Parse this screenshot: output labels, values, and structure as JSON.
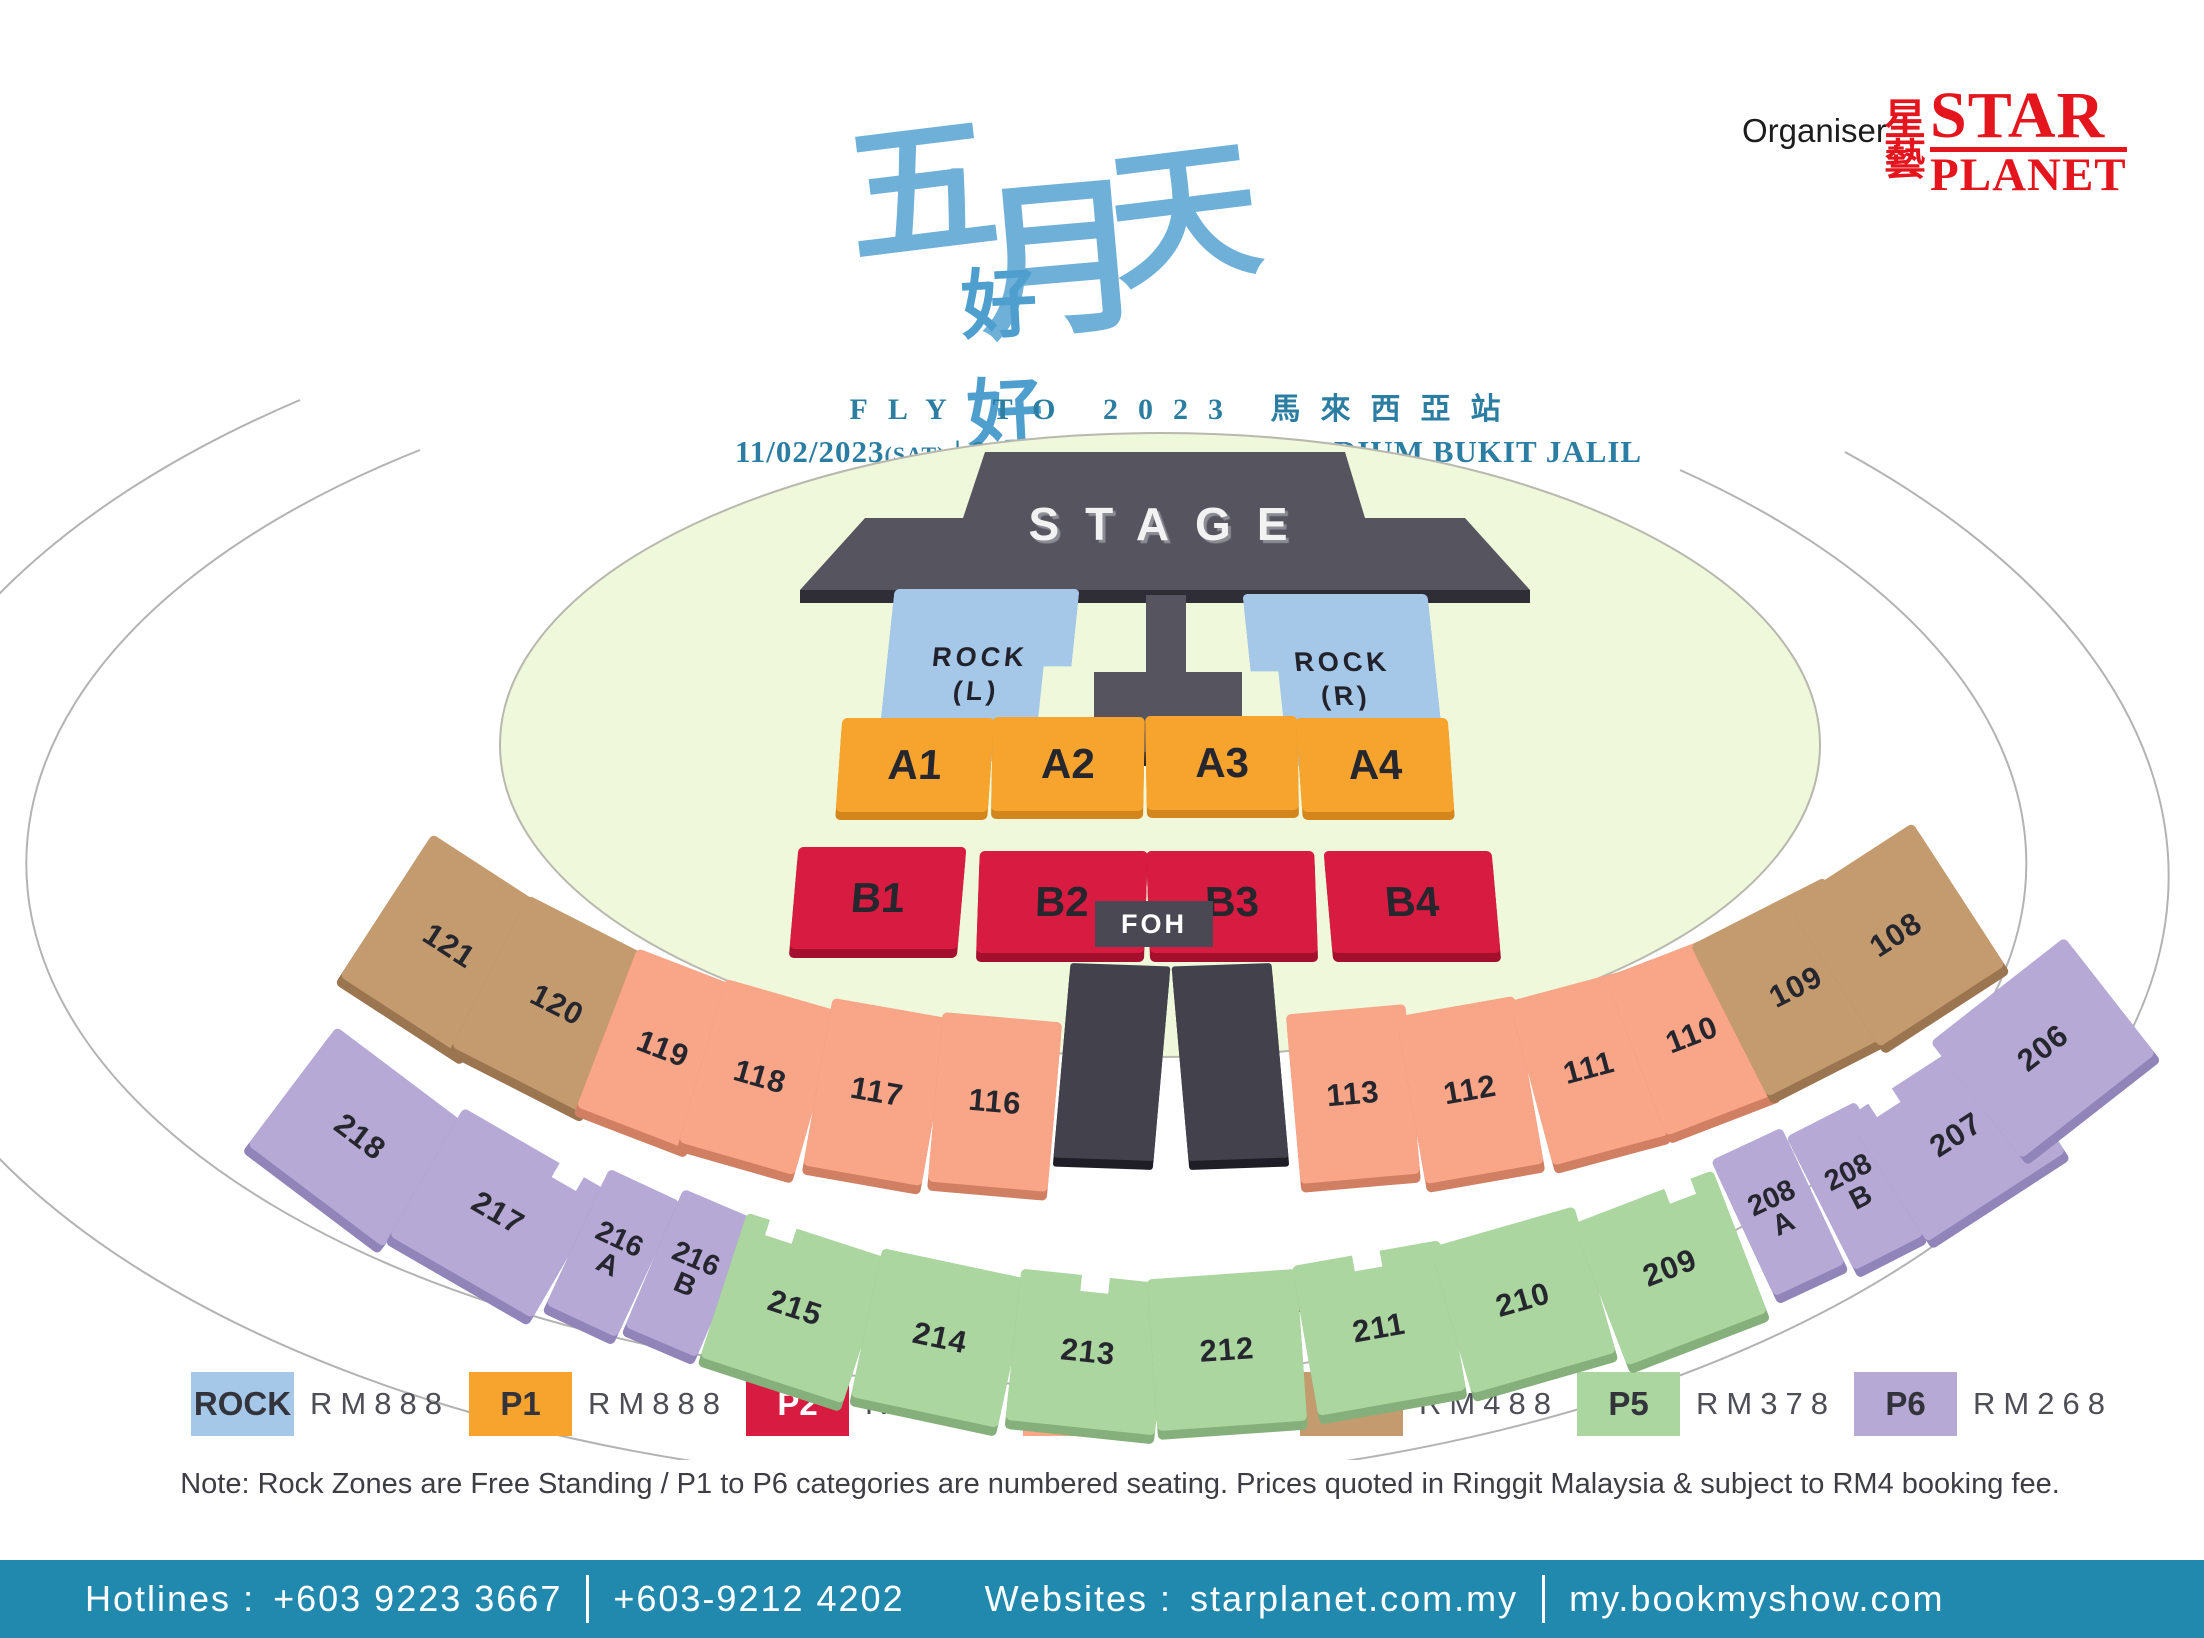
{
  "header": {
    "organiser_label": "Organiser",
    "logo": {
      "cjk_top": "星",
      "cjk_bottom": "藝",
      "star": "STAR",
      "planet": "PLANET",
      "color": "#e4151d"
    },
    "title": {
      "char1": "五",
      "char2": "月",
      "char3": "天",
      "line2": "好好好想見到你"
    },
    "tour_line": "FLY TO 2023 馬來西亞站",
    "event": {
      "date": "11/02/2023",
      "day": "(SAT)",
      "sep": "|",
      "time": "8:00",
      "meridiem": "PM",
      "venue": "NATIONAL STADIUM BUKIT JALIL"
    }
  },
  "map": {
    "stage_label": "STAGE",
    "foh_label": "FOH",
    "rock_left": {
      "line1": "ROCK",
      "line2": "(L)"
    },
    "rock_right": {
      "line1": "ROCK",
      "line2": "(R)"
    },
    "zones_a": [
      "A1",
      "A2",
      "A3",
      "A4"
    ],
    "zones_b": [
      "B1",
      "B2",
      "B3",
      "B4"
    ],
    "sections": {
      "121": "121",
      "120": "120",
      "119": "119",
      "118": "118",
      "117": "117",
      "116": "116",
      "113": "113",
      "112": "112",
      "111": "111",
      "110": "110",
      "109": "109",
      "108": "108",
      "218": "218",
      "217": "217",
      "216A": {
        "num": "216",
        "letter": "A"
      },
      "216B": {
        "num": "216",
        "letter": "B"
      },
      "215": "215",
      "214": "214",
      "213": "213",
      "212": "212",
      "211": "211",
      "210": "210",
      "209": "209",
      "208A": {
        "num": "208",
        "letter": "A"
      },
      "208B": {
        "num": "208",
        "letter": "B"
      },
      "207": "207",
      "206": "206"
    }
  },
  "caption": "Perspective Seat Map Not Drawn to Actual Scale",
  "legend": {
    "items": [
      {
        "code": "ROCK",
        "price": "RM888",
        "color": "#a5c8e9"
      },
      {
        "code": "P1",
        "price": "RM888",
        "color": "#f7a42e"
      },
      {
        "code": "P2",
        "price": "RM728",
        "color": "#d81b40"
      },
      {
        "code": "P3",
        "price": "RM598",
        "color": "#f8a588"
      },
      {
        "code": "P4",
        "price": "RM488",
        "color": "#c49b6e"
      },
      {
        "code": "P5",
        "price": "RM378",
        "color": "#abd69f"
      },
      {
        "code": "P6",
        "price": "RM268",
        "color": "#b6a9d6"
      }
    ]
  },
  "note": "Note: Rock Zones are Free Standing / P1 to P6 categories are numbered seating. Prices quoted in Ringgit Malaysia & subject to RM4 booking fee.",
  "footer": {
    "hotlines_label": "Hotlines :",
    "phone1": "+603 9223 3667",
    "phone2": "+603-9212 4202",
    "websites_label": "Websites :",
    "site1": "starplanet.com.my",
    "site2": "my.bookmyshow.com"
  }
}
